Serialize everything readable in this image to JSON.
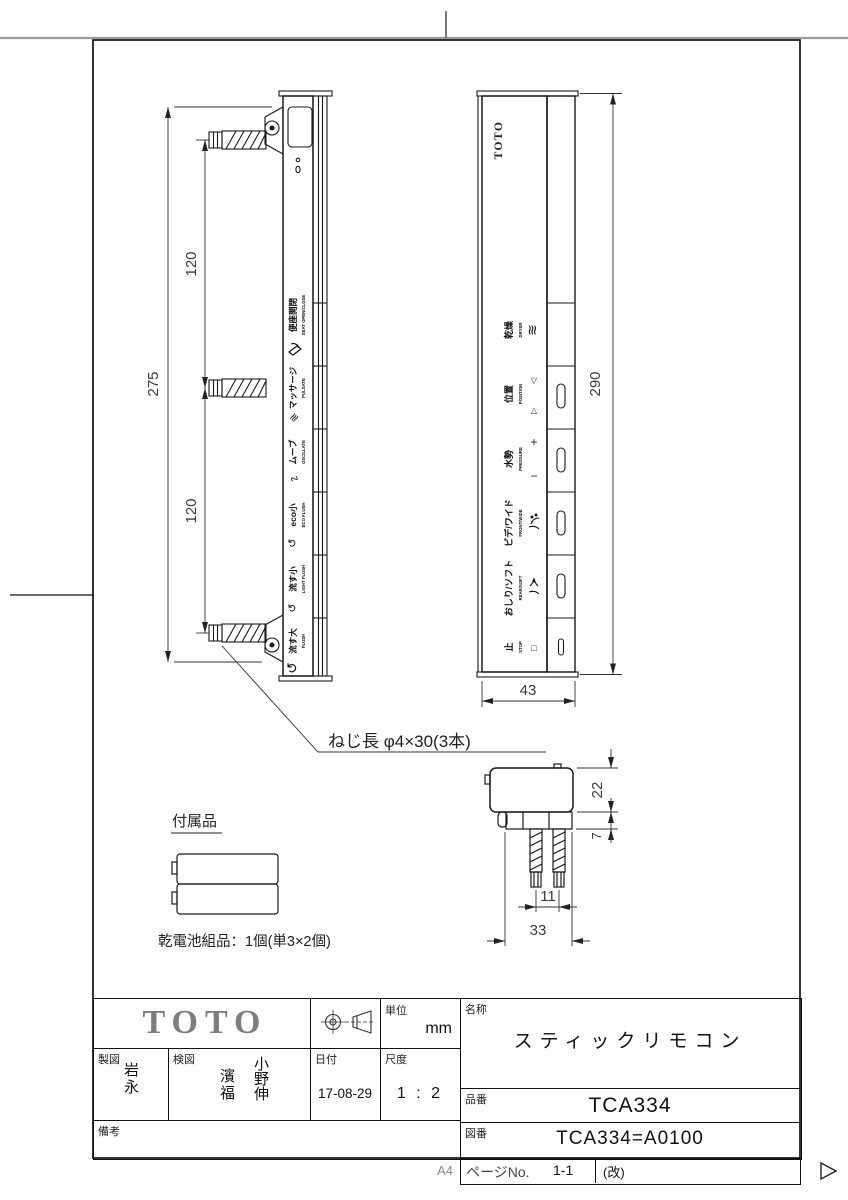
{
  "sheet": {
    "paper_size": "A4"
  },
  "side_view": {
    "dim_overall": "275",
    "dim_pitch_upper": "120",
    "dim_pitch_lower": "120",
    "buttons": [
      {
        "jp": "便座開閉",
        "en": "SEAT OPEN/CLOSE"
      },
      {
        "jp": "マッサージ",
        "en": "PULSATE",
        "icon": "≋"
      },
      {
        "jp": "ムーブ",
        "en": "OSCILLATE",
        "icon": "∿"
      },
      {
        "jp": "eco小",
        "en": "ECO FLUSH",
        "icon": "↺"
      },
      {
        "jp": "流す小",
        "en": "LIGHT FLUSH",
        "icon": "↺"
      },
      {
        "jp": "流す大",
        "en": "FLUSH",
        "icon": "↺"
      }
    ]
  },
  "front_view": {
    "logo": "TOTO",
    "dim_height": "290",
    "dim_width": "43",
    "buttons": [
      {
        "jp": "乾燥",
        "en": "DRYER",
        "icon": "≋"
      },
      {
        "jp": "位置",
        "en": "POSITION",
        "icon_up": "△",
        "icon_down": "▽"
      },
      {
        "jp": "水勢",
        "en": "PRESSURE",
        "icon_plus": "+",
        "icon_minus": "−"
      },
      {
        "jp": "ビデ/ワイド",
        "en": "FRONT/WIDE"
      },
      {
        "jp": "おしり/ソフト",
        "en": "REAR/SOFT"
      },
      {
        "jp": "止",
        "en": "STOP",
        "icon": "□"
      }
    ]
  },
  "bottom_view": {
    "dim_depth": "22",
    "dim_plate": "7",
    "dim_pitch": "11",
    "dim_width": "33"
  },
  "notes": {
    "screw": "ねじ長 φ4×30(3本)"
  },
  "accessory": {
    "title": "付属品",
    "caption": "乾電池組品：1個(単3×2個)"
  },
  "title_block": {
    "logo": "TOTO",
    "unit_label": "単位",
    "unit_value": "mm",
    "drafter_label": "製図",
    "drafter_name": "岩永",
    "checker_label": "検図",
    "checker_name_1": "濱福",
    "checker_name_2": "小野伸",
    "date_label": "日付",
    "date_value": "17-08-29",
    "scale_label": "尺度",
    "scale_value": "1 : 2",
    "remarks_label": "備考",
    "name_label": "名称",
    "name_value": "スティックリモコン",
    "part_no_label": "品番",
    "part_no_value": "TCA334",
    "drawing_no_label": "図番",
    "drawing_no_value": "TCA334=A0100",
    "page_no_label": "ページNo.",
    "page_no_value": "1-1",
    "revision_label": "(改)"
  }
}
